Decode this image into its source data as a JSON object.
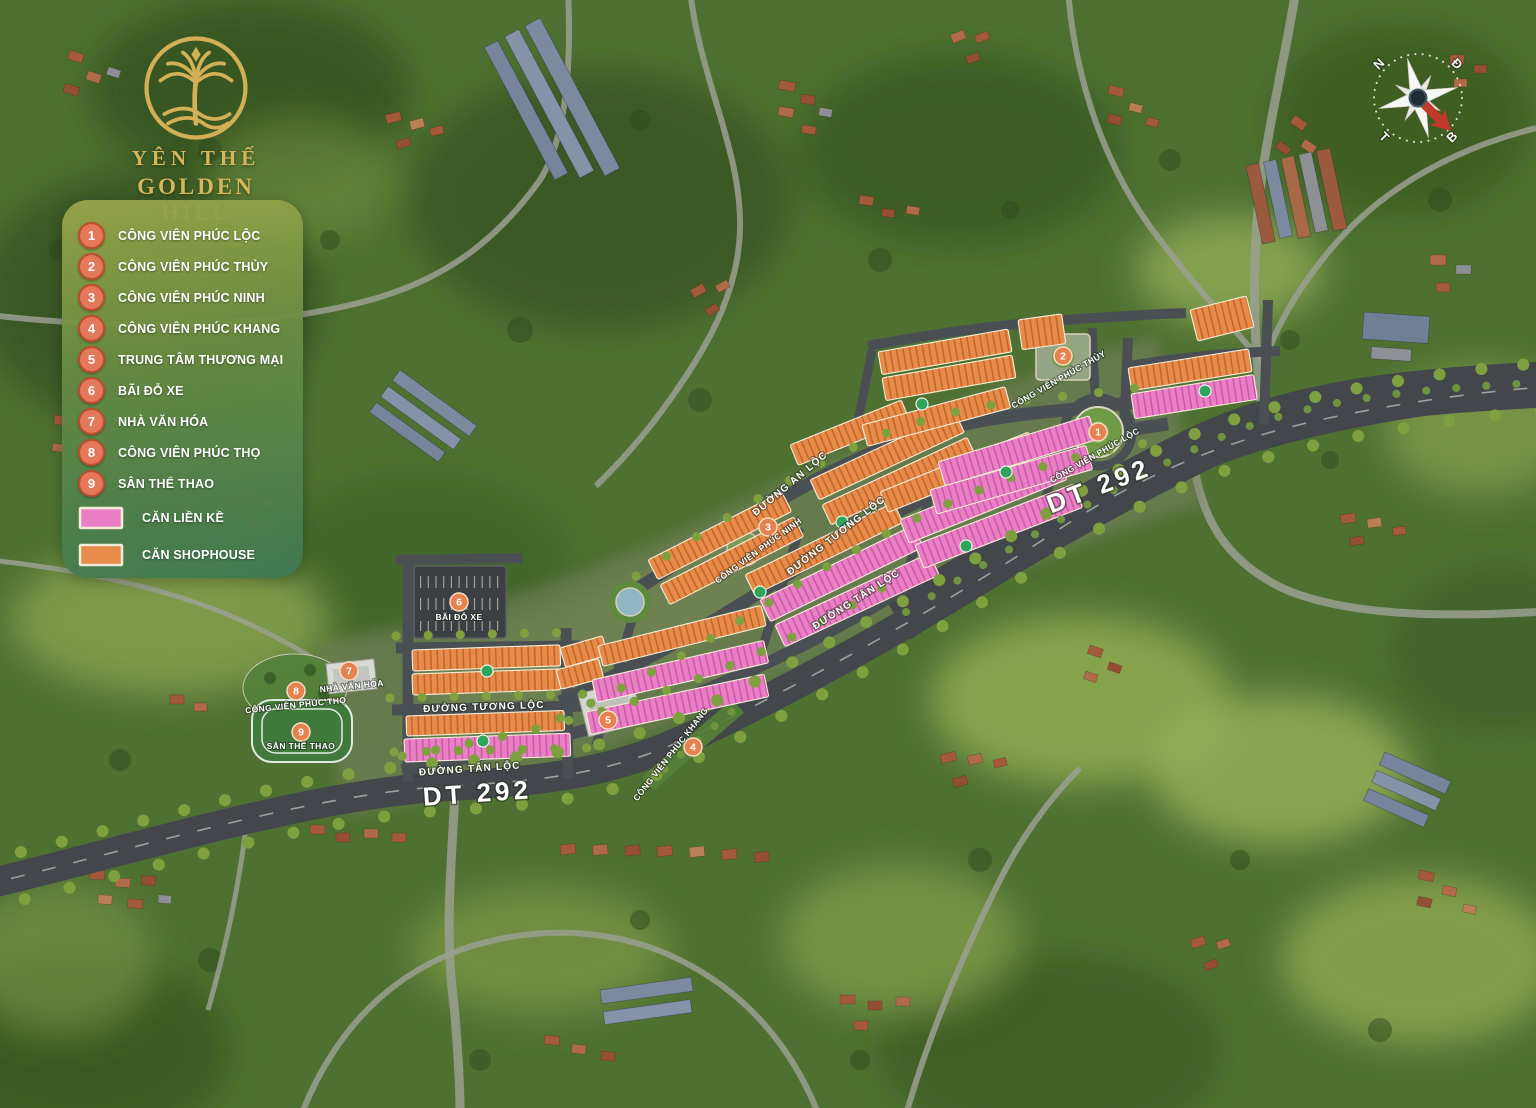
{
  "project": {
    "logo_line1": "YÊN THẾ",
    "logo_line2": "GOLDEN HILL"
  },
  "legend": {
    "items": [
      {
        "n": "1",
        "label": "CÔNG VIÊN PHÚC LỘC"
      },
      {
        "n": "2",
        "label": "CÔNG VIÊN PHÚC THỦY"
      },
      {
        "n": "3",
        "label": "CÔNG VIÊN PHÚC NINH"
      },
      {
        "n": "4",
        "label": "CÔNG VIÊN PHÚC KHANG"
      },
      {
        "n": "5",
        "label": "TRUNG TÂM THƯƠNG MẠI"
      },
      {
        "n": "6",
        "label": "BÃI ĐỖ XE"
      },
      {
        "n": "7",
        "label": "NHÀ VĂN HÓA"
      },
      {
        "n": "8",
        "label": "CÔNG VIÊN PHÚC THỌ"
      },
      {
        "n": "9",
        "label": "SÂN THỂ THAO"
      }
    ],
    "swatches": [
      {
        "label": "CĂN LIỀN KỀ",
        "color": "#ea7fc5"
      },
      {
        "label": "CĂN SHOPHOUSE",
        "color": "#e78b4b"
      }
    ]
  },
  "compass": {
    "top_left": "N",
    "top_right": "Đ",
    "bottom_right": "B",
    "bottom_left": "T"
  },
  "map": {
    "colors": {
      "shophouse": "#e78b4b",
      "lien_ke": "#ea7fc5",
      "road": "#43474b"
    },
    "road_labels": {
      "dt292_left": "DT 292",
      "dt292_right": "DT 292",
      "an_loc": "ĐƯỜNG AN LỘC",
      "tuong_loc_upper": "ĐƯỜNG TƯƠNG LỘC",
      "tuong_loc_lower": "ĐƯỜNG TƯƠNG LỘC",
      "tan_loc_upper": "ĐƯỜNG TÂN LỘC",
      "tan_loc_lower": "ĐƯỜNG TÂN LỘC"
    }
  }
}
